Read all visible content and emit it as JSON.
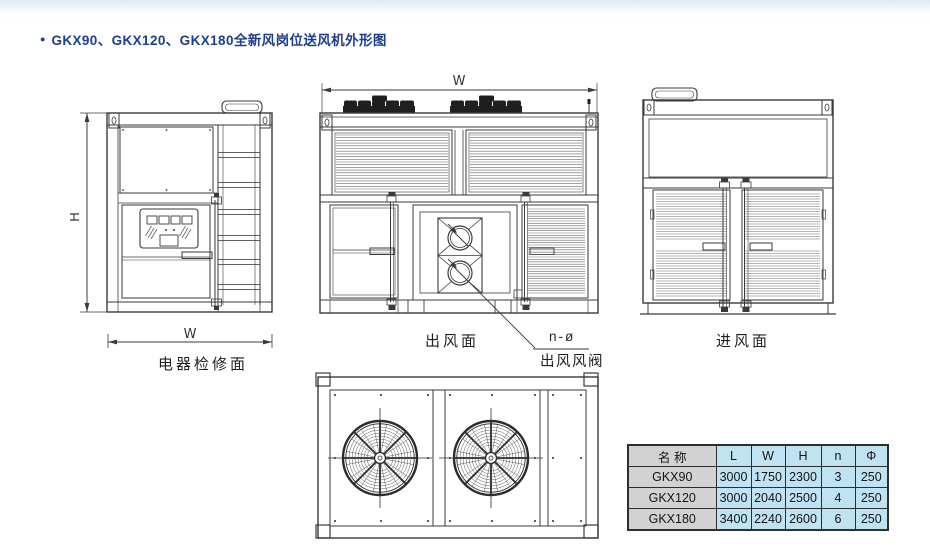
{
  "title": {
    "bullet": "●",
    "text": "GKX90、GKX120、GKX180全新风岗位送风机外形图",
    "color": "#1c3e8c"
  },
  "drawings": {
    "left_elevation": {
      "label": "电器检修面",
      "dim_height": "H",
      "dim_width": "W"
    },
    "front_elevation": {
      "label": "出风面",
      "dim_width": "W",
      "callout_value": "n-ø",
      "callout_label": "出风风阀"
    },
    "right_elevation": {
      "label": "进风面"
    }
  },
  "spec_table": {
    "columns": [
      "名 称",
      "L",
      "W",
      "H",
      "n",
      "Φ"
    ],
    "rows": [
      {
        "name": "GKX90",
        "L": "3000",
        "W": "1750",
        "H": "2300",
        "n": "3",
        "phi": "250"
      },
      {
        "name": "GKX120",
        "L": "3000",
        "W": "2040",
        "H": "2500",
        "n": "4",
        "phi": "250"
      },
      {
        "name": "GKX180",
        "L": "3400",
        "W": "2240",
        "H": "2600",
        "n": "6",
        "phi": "250"
      }
    ],
    "name_col_bg": "#d2d2d2",
    "data_col_bg": "#bfe3f2",
    "border_color": "#2e2e2e"
  },
  "line_color": "#3a3a3a"
}
